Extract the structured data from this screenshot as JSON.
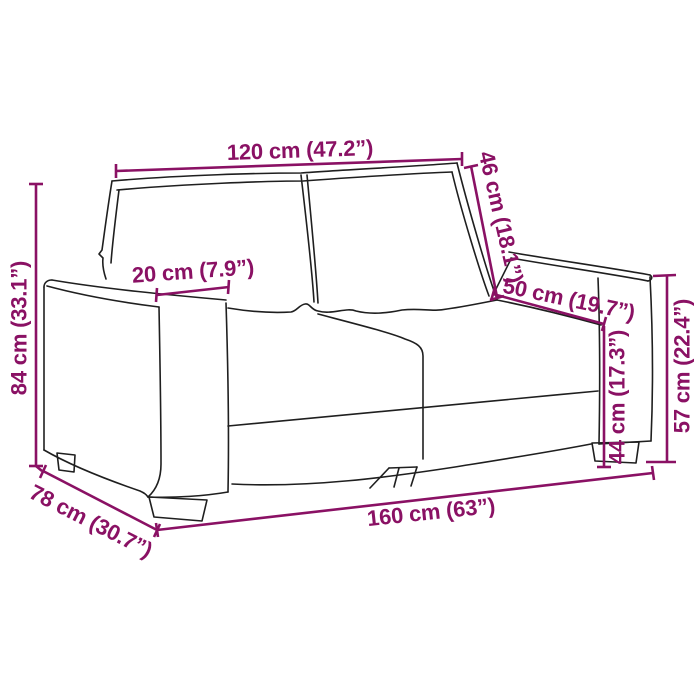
{
  "diagram": {
    "subject": "2-seater sofa line drawing with measurements",
    "colors": {
      "dimension": "#8A1164",
      "outline": "#1F1F1F",
      "background": "#FFFFFF"
    },
    "dimensions": {
      "seat_width": {
        "label": "120 cm (47.2”)"
      },
      "backrest_height": {
        "label": "46 cm (18.1”)"
      },
      "armrest_width": {
        "label": "20 cm (7.9”)"
      },
      "seat_depth": {
        "label": "50 cm (19.7”)"
      },
      "seat_height": {
        "label": "44 cm (17.3”)"
      },
      "armrest_height": {
        "label": "57 cm (22.4”)"
      },
      "total_height": {
        "label": "84 cm (33.1”)"
      },
      "total_depth": {
        "label": "78 cm (30.7”)"
      },
      "total_width": {
        "label": "160 cm (63”)"
      }
    }
  }
}
